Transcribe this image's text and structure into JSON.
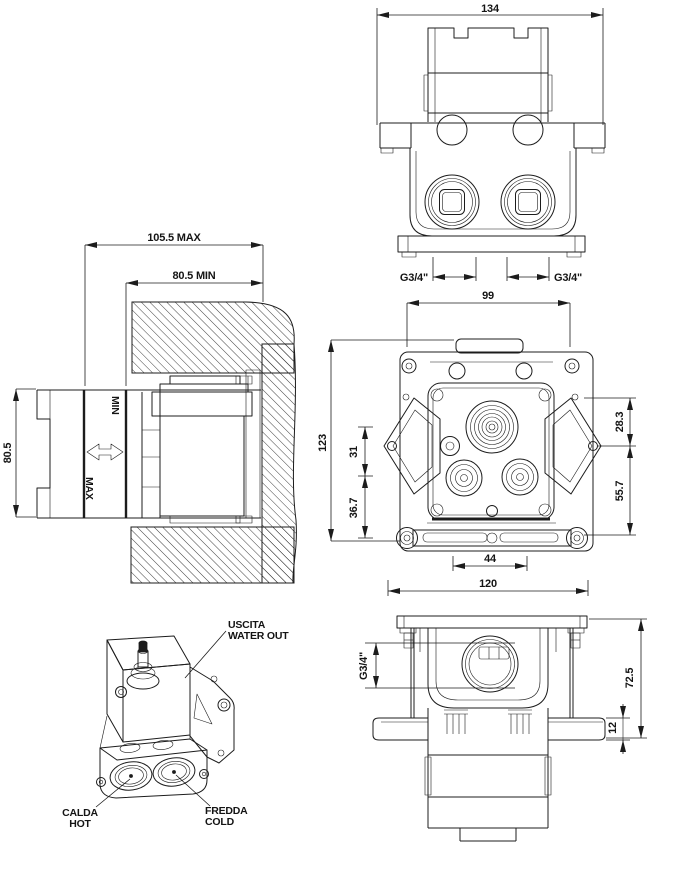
{
  "top_view": {
    "dim_overall_width": "134",
    "port_left_label": "G3/4\"",
    "port_right_label": "G3/4\""
  },
  "side_view": {
    "dim_depth_max": "105.5 MAX",
    "dim_depth_min": "80.5 MIN",
    "dim_body_height": "80.5",
    "plaster_min_label": "MIN",
    "plaster_max_label": "MAX"
  },
  "front_view": {
    "dim_flange_width": "99",
    "dim_overall_height": "123",
    "dim_center_to_outlets": "31",
    "dim_outlets_to_base": "36.7",
    "dim_top_holes_to_center": "28.3",
    "dim_center_to_base": "55.7",
    "dim_outlet_spacing": "44",
    "dim_overall_width": "120"
  },
  "iso_view": {
    "outlet_label_it": "USCITA",
    "outlet_label_en": "WATER OUT",
    "hot_label_it": "CALDA",
    "hot_label_en": "HOT",
    "cold_label_it": "FREDDA",
    "cold_label_en": "COLD"
  },
  "bottom_view": {
    "port_label": "G3/4\"",
    "dim_overall_height": "72.5",
    "dim_flange_thickness": "12"
  }
}
